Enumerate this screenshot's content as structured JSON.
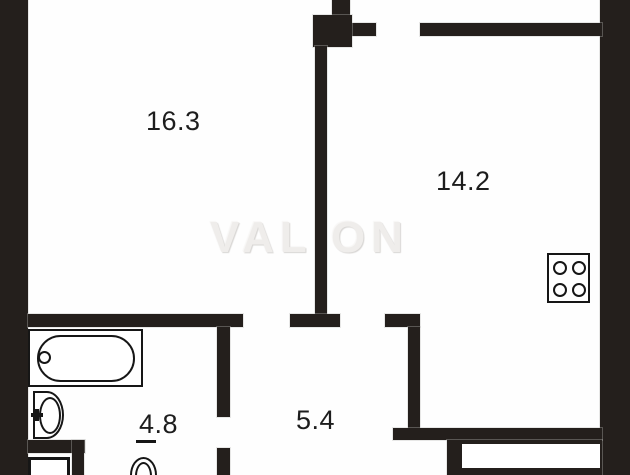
{
  "plan": {
    "watermark": "VALION",
    "room_labels": {
      "room_a": "16.3",
      "room_b": "14.2",
      "bath": "4.8",
      "hall": "5.4"
    },
    "colors": {
      "wall": "#241f1c",
      "fixture_line": "#161616",
      "background": "#fefefe",
      "label_text": "#1d1d1d",
      "watermark_text": "#efedeb"
    },
    "fixtures": [
      {
        "icon": "bathtub-icon"
      },
      {
        "icon": "sink-icon"
      },
      {
        "icon": "toilet-icon"
      },
      {
        "icon": "shower-tray-icon"
      },
      {
        "icon": "stove-icon"
      }
    ]
  }
}
